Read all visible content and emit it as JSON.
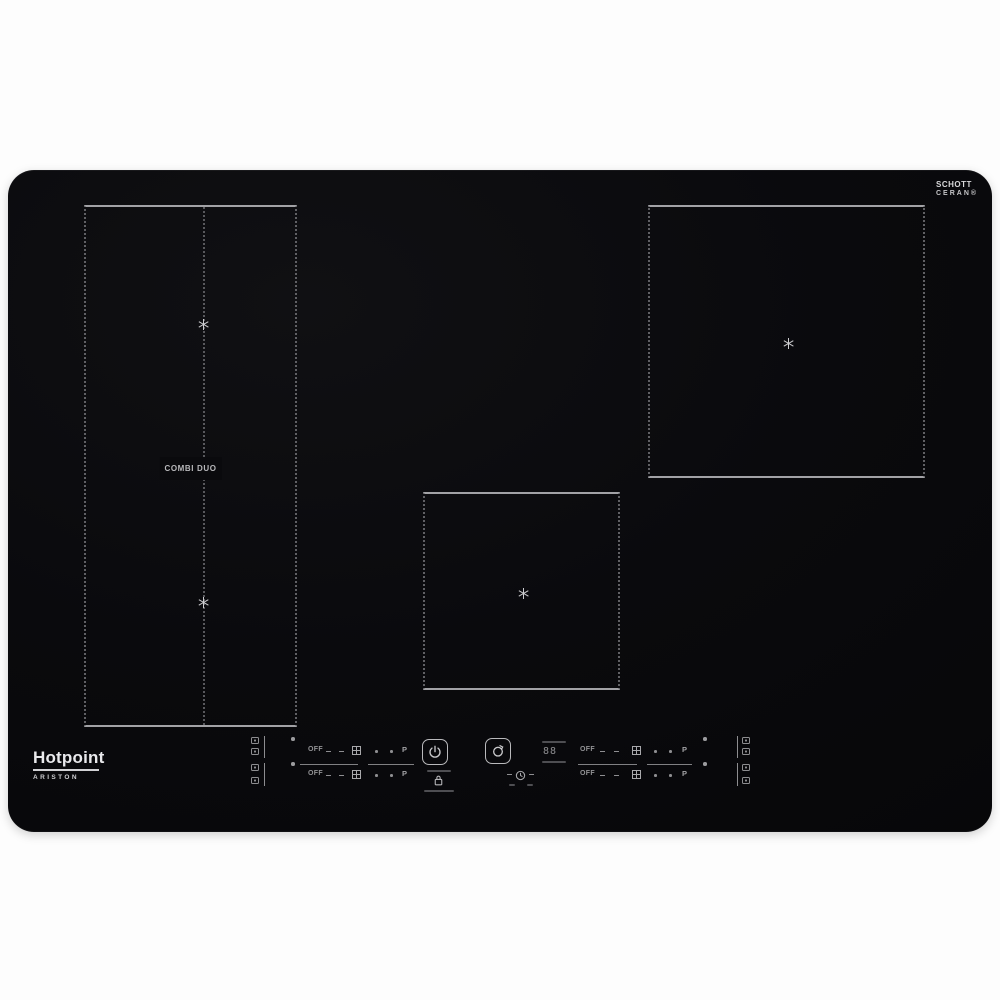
{
  "branding": {
    "logo_text": "Hotpoint",
    "logo_subtext": "ARISTON",
    "glass_logo_line1": "SCHOTT",
    "glass_logo_line2": "CERAN®"
  },
  "zones": {
    "left_flexi_label": "COMBI DUO",
    "marker_icon": "six-spoke-star-icon"
  },
  "controls": {
    "off_label": "OFF",
    "booster_label": "P",
    "timer_value": "88",
    "icons": {
      "power": "power-icon",
      "lock": "key-lock-icon",
      "function": "pan-function-icon",
      "boost_square": "booster-grid-icon",
      "zone_map": "zone-map-icon",
      "timer_clock": "clock-icon"
    }
  },
  "colors": {
    "background": "#ffffff",
    "glass": "#0a0a0d",
    "zone_line_solid": "#a2a2a6",
    "zone_line_dotted": "#606064",
    "glyph": "#9a9a9d"
  }
}
